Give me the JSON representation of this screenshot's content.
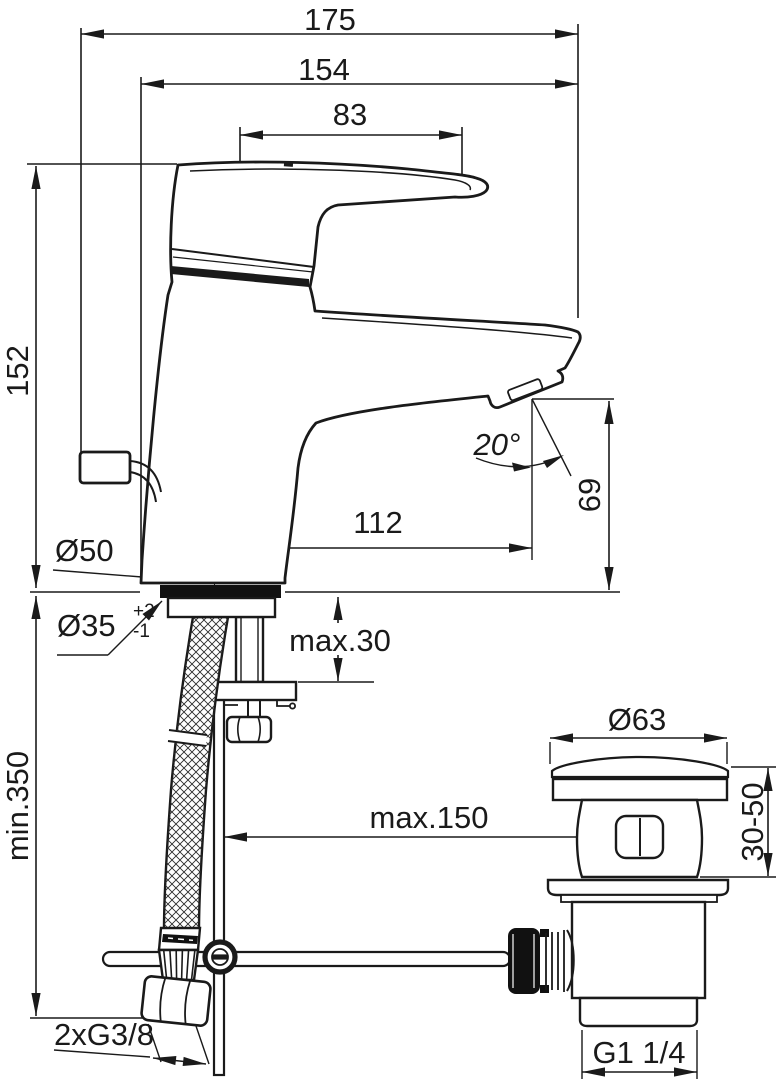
{
  "style": {
    "ink": "#1a1a1a",
    "background": "#ffffff"
  },
  "labels": {
    "overall_width": "175",
    "projection": "154",
    "lever_length": "83",
    "body_height": "152",
    "spout_reach": "112",
    "spout_angle": "20°",
    "spout_height": "69",
    "base_diameter": "Ø50",
    "hole_diameter": "Ø35",
    "hole_tol_plus": "+2",
    "hole_tol_minus": "-1",
    "deck_thickness": "max.30",
    "hose_length": "min.350",
    "rod_travel": "max.150",
    "waste_cap_diameter": "Ø63",
    "waste_deck_range": "30-50",
    "supply_thread": "2xG3/8",
    "waste_thread": "G1 1/4"
  }
}
